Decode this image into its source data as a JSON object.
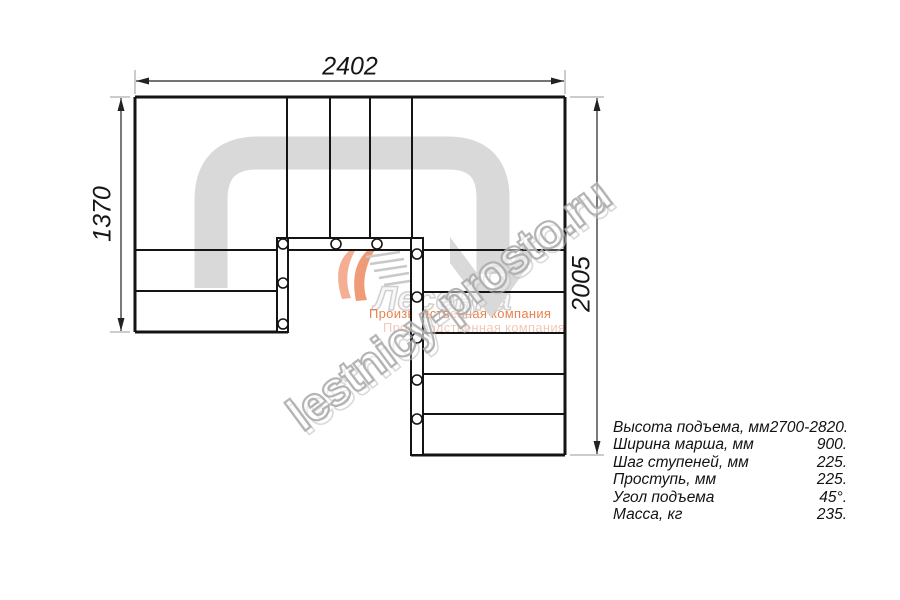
{
  "drawing": {
    "dim_top_width": "2402",
    "dim_left_height": "1370",
    "dim_right_height": "2005",
    "walkline_color": "#d9d9d9",
    "line_color": "#141414"
  },
  "logo": {
    "wordmark": "Лесенка",
    "tagline": "Производственная компания",
    "orange": "#ed8a5a"
  },
  "watermark": {
    "text": "lestnicy-prosto.ru",
    "outline_color": "#a8a8a8"
  },
  "specs": {
    "rows": [
      {
        "label": "Высота подъема, мм",
        "value": "2700-2820."
      },
      {
        "label": "Ширина марша, мм",
        "value": "900."
      },
      {
        "label": "Шаг ступеней, мм",
        "value": "225."
      },
      {
        "label": "Проступь, мм",
        "value": "225."
      },
      {
        "label": "Угол подъема",
        "value": "45°."
      },
      {
        "label": "Масса, кг",
        "value": "235."
      }
    ]
  }
}
